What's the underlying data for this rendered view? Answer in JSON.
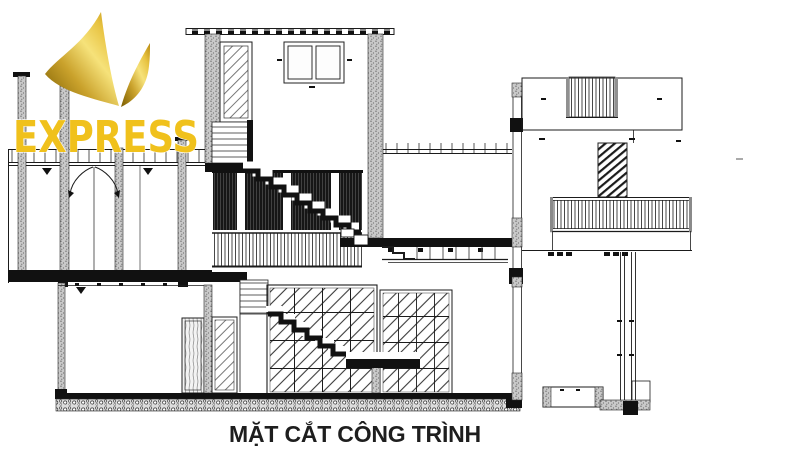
{
  "watermark": {
    "brand": "EXPRESS",
    "colors": {
      "gold": "#F0C11C",
      "gold_dark": "#7a5c00",
      "gold_light": "#F6E27A"
    }
  },
  "caption": {
    "title": "MẶT CẮT CÔNG TRÌNH"
  },
  "drawing": {
    "ink": "#1b1b1b",
    "kind": "architectural-cross-section"
  }
}
